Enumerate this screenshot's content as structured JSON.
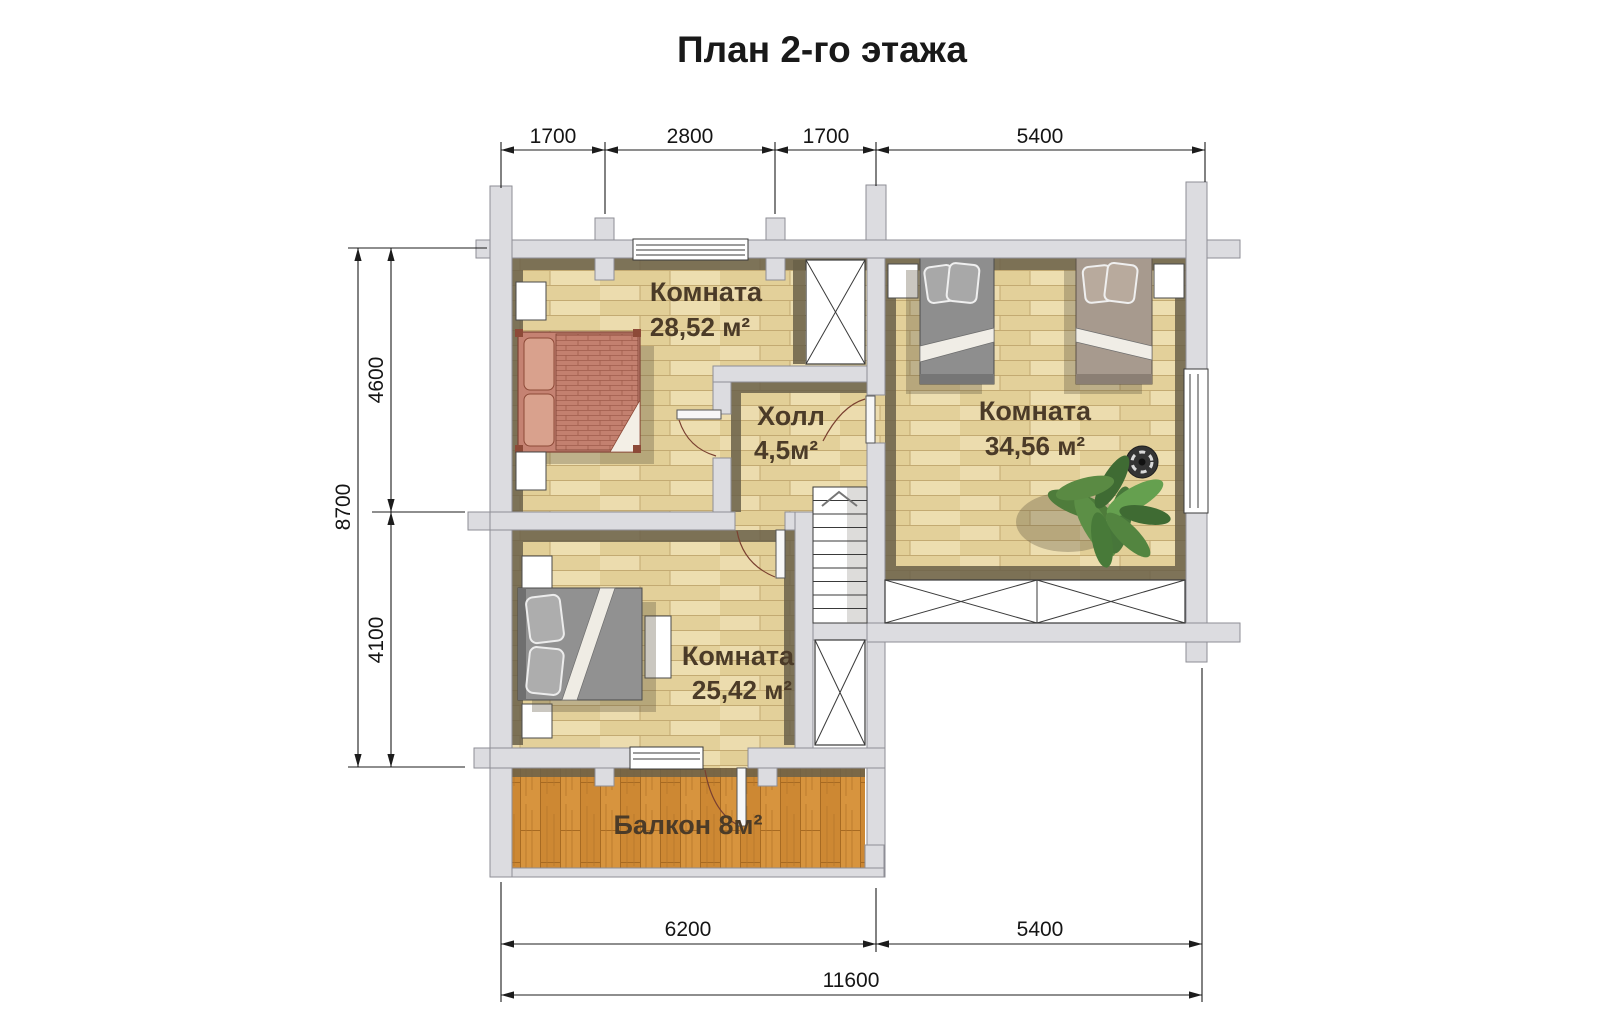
{
  "title": "План 2-го этажа",
  "rooms": {
    "room1": {
      "name": "Комната",
      "area": "28,52 м²"
    },
    "hall": {
      "name": "Холл",
      "area": "4,5м²"
    },
    "room2": {
      "name": "Комната",
      "area": "34,56 м²"
    },
    "room3": {
      "name": "Комната",
      "area": "25,42 м²"
    },
    "balcony": {
      "label": "Балкон 8м²"
    }
  },
  "dimensions": {
    "top": [
      "1700",
      "2800",
      "1700",
      "5400"
    ],
    "left": {
      "total": "8700",
      "segments": [
        "4600",
        "4100"
      ]
    },
    "bottom": {
      "segments": [
        "6200",
        "5400"
      ],
      "total": "11600"
    }
  },
  "colors": {
    "wall": "#dcdce0",
    "wall_outline": "#8e8e96",
    "floor_parquet": "#e8d8a5",
    "floor_balcony": "#d7943e",
    "floor_shadow": "#6a6049",
    "bed_terracotta": "#c3806f",
    "bed_gray": "#8e8e8e",
    "label_text": "#4b3b28",
    "dimension_text": "#1c1c1c",
    "plant_green": "#4e7c3b"
  }
}
